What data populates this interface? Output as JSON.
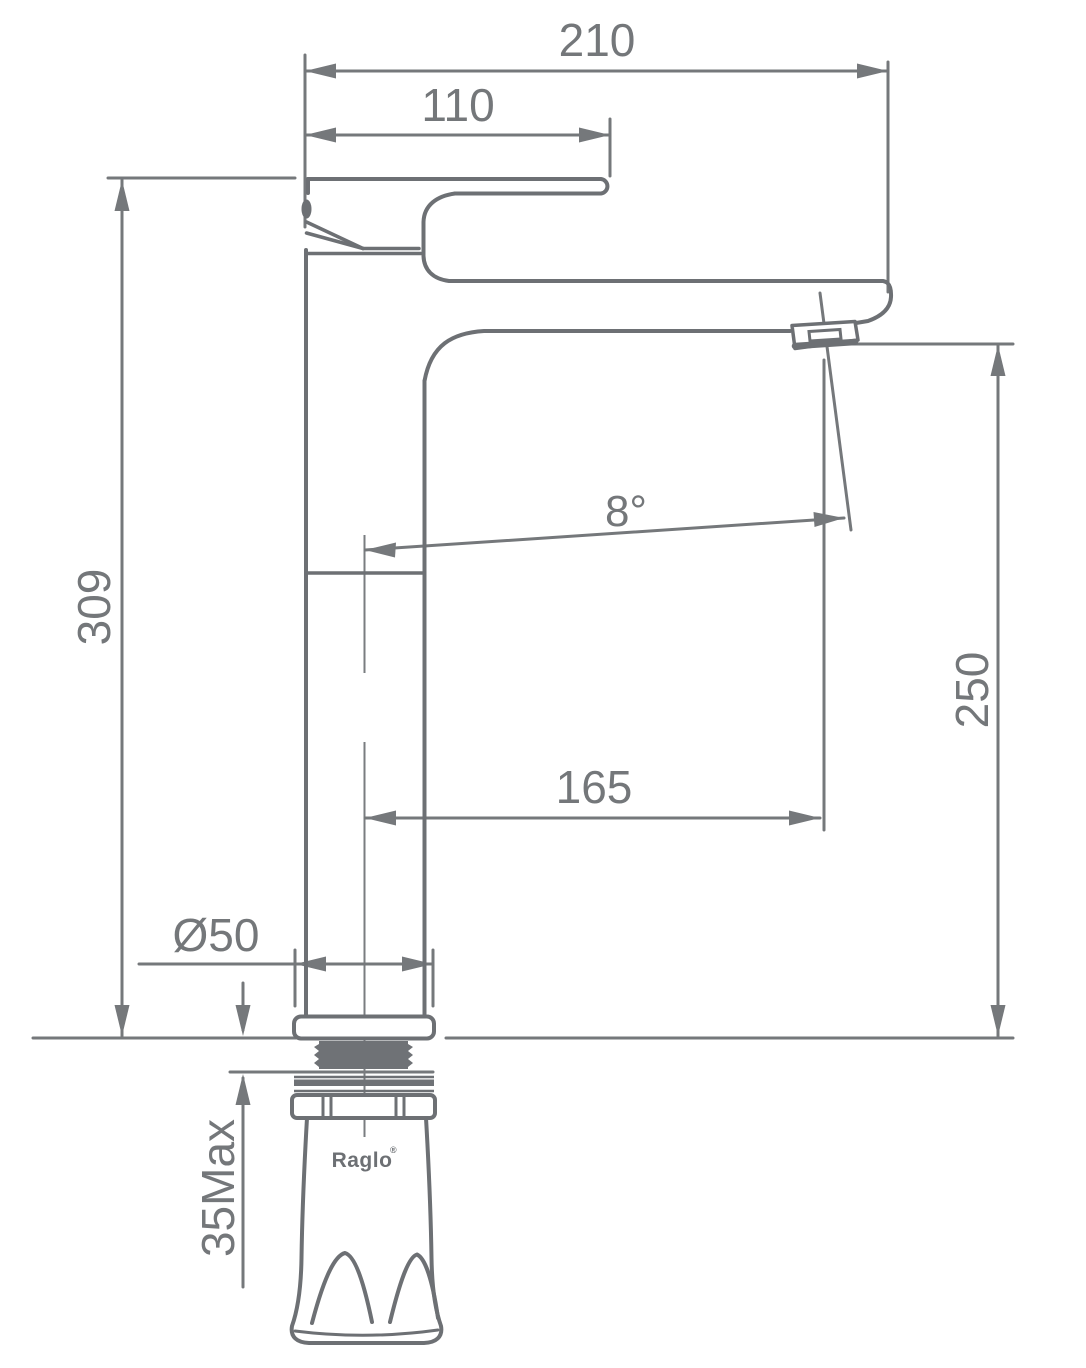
{
  "drawing": {
    "kind": "technical-dimension-drawing",
    "subject": "tall single-lever basin mixer tap, side elevation",
    "line_color": "#6e7175",
    "background": "#ffffff"
  },
  "labels": {
    "overall_width": "210",
    "handle_length": "110",
    "overall_height": "309",
    "spout_height": "250",
    "spout_reach": "165",
    "spout_angle": "8°",
    "base_diameter": "Ø50",
    "deck_thickness": "35Max",
    "brand": "Raglo",
    "brand_mark": "®"
  },
  "dimensions": [
    {
      "id": "overall-width",
      "value": "210",
      "orientation": "horizontal",
      "measures": "overall width across handle and spout"
    },
    {
      "id": "handle-length",
      "value": "110",
      "orientation": "horizontal",
      "measures": "lever handle length"
    },
    {
      "id": "overall-height",
      "value": "309",
      "orientation": "vertical",
      "measures": "total height above deck"
    },
    {
      "id": "spout-height",
      "value": "250",
      "orientation": "vertical",
      "measures": "spout outlet height above deck"
    },
    {
      "id": "spout-reach",
      "value": "165",
      "orientation": "horizontal",
      "measures": "spout reach from body axis to outlet"
    },
    {
      "id": "spout-angle",
      "value": "8°",
      "orientation": "angular",
      "measures": "spout outlet tilt"
    },
    {
      "id": "base-diameter",
      "value": "Ø50",
      "orientation": "horizontal",
      "measures": "base flange diameter"
    },
    {
      "id": "deck-thickness",
      "value": "35Max",
      "orientation": "vertical",
      "measures": "maximum mounting deck thickness"
    }
  ]
}
